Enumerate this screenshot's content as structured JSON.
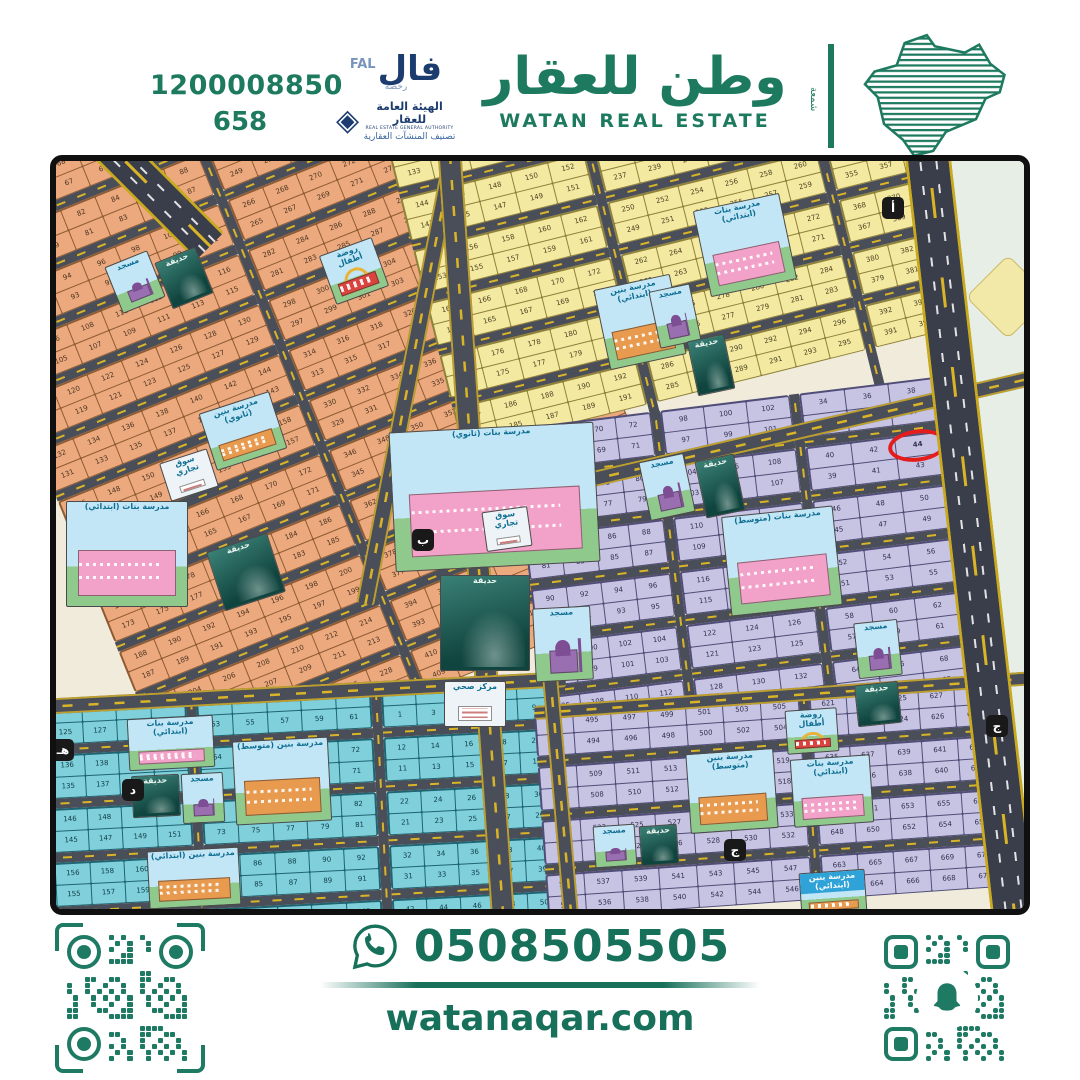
{
  "header": {
    "unified_number": "1200008850",
    "license_number": "658",
    "fal": {
      "logo_ar": "فال",
      "logo_en": "FAL",
      "license_word": "رخصة",
      "authority_ar": "الهيئة العامة للعقار",
      "authority_en": "REAL ESTATE GENERAL AUTHORITY",
      "classification": "تصنيف المنشآت العقارية"
    },
    "brand_ar": "وطن للعقار",
    "brand_en": "WATAN REAL ESTATE",
    "brand_vertical": "شمعة"
  },
  "footer": {
    "phone": "0508505505",
    "website": "watanaqar.com"
  },
  "colors": {
    "brand_teal": "#1E7A5F",
    "navy": "#1C3C70",
    "highlight_red": "#E41C1C",
    "road": "#4A4E58",
    "road_dash": "#D9B427"
  },
  "map": {
    "background": "#F0EBDA",
    "highlight": {
      "district": "lav-right",
      "number": 44,
      "color": "#E41C1C"
    },
    "districts": [
      {
        "id": "orange",
        "x": -160,
        "y": -60,
        "w": 560,
        "h": 760,
        "rot": -22,
        "fill": "#ECA97E",
        "line": "#8F5B33",
        "num": "#4A3422",
        "cols": [
          {
            "w": 260,
            "start": 33
          },
          {
            "w": 290,
            "start": 201
          }
        ]
      },
      {
        "id": "yellow",
        "x": 305,
        "y": -120,
        "w": 650,
        "h": 470,
        "rot": -14,
        "fill": "#F4E9A1",
        "line": "#8F823B",
        "num": "#4A4322",
        "cols": [
          {
            "w": 190,
            "start": 113
          },
          {
            "w": 215,
            "start": 201
          },
          {
            "w": 215,
            "start": 307
          }
        ]
      },
      {
        "id": "lav-right",
        "x": 455,
        "y": 268,
        "w": 560,
        "h": 480,
        "rot": -7,
        "fill": "#C7C3E3",
        "line": "#504E78",
        "num": "#30304E",
        "cols": [
          {
            "w": 140,
            "start": 65
          },
          {
            "w": 130,
            "start": 97
          },
          {
            "w": 135,
            "start": 33
          },
          {
            "w": 135,
            "start": 1
          }
        ]
      },
      {
        "id": "cyan",
        "x": -45,
        "y": 542,
        "w": 540,
        "h": 280,
        "rot": -3,
        "fill": "#7FD0DB",
        "line": "#1F6472",
        "num": "#0E3A44",
        "cols": [
          {
            "w": 175,
            "start": 123
          },
          {
            "w": 175,
            "start": 53
          },
          {
            "w": 170,
            "start": 1
          }
        ]
      },
      {
        "id": "lav-south",
        "x": 478,
        "y": 552,
        "w": 540,
        "h": 230,
        "rot": -4,
        "fill": "#C7C3E3",
        "line": "#504E78",
        "num": "#30304E",
        "cols": [
          {
            "w": 265,
            "start": 492
          },
          {
            "w": 255,
            "start": 620
          }
        ]
      }
    ],
    "roads": [
      {
        "x": 390,
        "y": -20,
        "w": 18,
        "h": 470,
        "rot": 11,
        "kind": "main"
      },
      {
        "x": 380,
        "y": -30,
        "w": 24,
        "h": 840,
        "rot": -4,
        "kind": "main"
      },
      {
        "x": 450,
        "y": 330,
        "w": 570,
        "h": 16,
        "rot": -13,
        "kind": "mainh"
      },
      {
        "x": -20,
        "y": 538,
        "w": 530,
        "h": 16,
        "rot": -3,
        "kind": "mainh"
      },
      {
        "x": 478,
        "y": 545,
        "w": 540,
        "h": 14,
        "rot": -4,
        "kind": "mainh"
      },
      {
        "x": 486,
        "y": 515,
        "w": 16,
        "h": 240,
        "rot": -5,
        "kind": "main"
      },
      {
        "x": 848,
        "y": -10,
        "w": 46,
        "h": 790,
        "rot": -6.5,
        "kind": "highway"
      },
      {
        "x": -30,
        "y": -70,
        "w": 40,
        "h": 240,
        "rot": -45,
        "kind": "highway"
      }
    ],
    "beyond": {
      "x": 890,
      "y": -20,
      "w": 170,
      "h": 820,
      "rot": -6.5
    },
    "arrow": {
      "x": 922,
      "y": 106,
      "size": 60
    },
    "chips": [
      {
        "label": "أ",
        "x": 826,
        "y": 36
      },
      {
        "label": "ب",
        "x": 356,
        "y": 368
      },
      {
        "label": "ج",
        "x": 668,
        "y": 678
      },
      {
        "label": "ج",
        "x": 930,
        "y": 554
      },
      {
        "label": "د",
        "x": 66,
        "y": 618
      },
      {
        "label": "هـ",
        "x": -4,
        "y": 578
      }
    ],
    "landmarks": [
      {
        "type": "mosque",
        "label": "مسجد",
        "x": 56,
        "y": 96,
        "w": 46,
        "h": 50,
        "rot": -22
      },
      {
        "type": "park",
        "label": "حديقة",
        "x": 106,
        "y": 92,
        "w": 44,
        "h": 50,
        "rot": -22
      },
      {
        "type": "kindergarten",
        "label": "روضة أطفال",
        "x": 270,
        "y": 84,
        "w": 56,
        "h": 52,
        "rot": -20
      },
      {
        "type": "school-orange",
        "label": "مدرسة بنين (ثانوي)",
        "x": 150,
        "y": 240,
        "w": 74,
        "h": 60,
        "rot": -18
      },
      {
        "type": "market",
        "label": "سوق تجاري",
        "x": 108,
        "y": 294,
        "w": 50,
        "h": 40,
        "rot": -18
      },
      {
        "type": "school-pink",
        "label": "مدرسة بنات (ابتدائي)",
        "x": 10,
        "y": 340,
        "w": 122,
        "h": 106,
        "rot": 0
      },
      {
        "type": "park",
        "label": "حديقة",
        "x": 158,
        "y": 380,
        "w": 64,
        "h": 62,
        "rot": -18
      },
      {
        "type": "school-pink",
        "label": "مدرسة بنات (ثانوي)",
        "x": 336,
        "y": 266,
        "w": 205,
        "h": 140,
        "rot": -3
      },
      {
        "type": "market",
        "label": "سوق تجاري",
        "x": 428,
        "y": 348,
        "w": 46,
        "h": 40,
        "rot": -8
      },
      {
        "type": "park",
        "label": "حديقة",
        "x": 384,
        "y": 414,
        "w": 90,
        "h": 96,
        "rot": 0
      },
      {
        "type": "mosque",
        "label": "مسجد",
        "x": 478,
        "y": 446,
        "w": 58,
        "h": 74,
        "rot": -3
      },
      {
        "type": "health",
        "label": "مركز صحي",
        "x": 388,
        "y": 520,
        "w": 62,
        "h": 46,
        "rot": 0
      },
      {
        "type": "school-pink",
        "label": "مدرسة بنات (ابتدائي)",
        "x": 645,
        "y": 40,
        "w": 88,
        "h": 88,
        "rot": -12
      },
      {
        "type": "school-orange",
        "label": "مدرسة بنين (ابتدائي)",
        "x": 545,
        "y": 120,
        "w": 78,
        "h": 82,
        "rot": -12
      },
      {
        "type": "mosque",
        "label": "مسجد",
        "x": 598,
        "y": 126,
        "w": 42,
        "h": 58,
        "rot": -12
      },
      {
        "type": "park",
        "label": "حديقة",
        "x": 636,
        "y": 176,
        "w": 38,
        "h": 56,
        "rot": -12
      },
      {
        "type": "mosque",
        "label": "مسجد",
        "x": 588,
        "y": 296,
        "w": 46,
        "h": 60,
        "rot": -12
      },
      {
        "type": "park",
        "label": "حديقة",
        "x": 644,
        "y": 296,
        "w": 40,
        "h": 58,
        "rot": -12
      },
      {
        "type": "school-pink",
        "label": "مدرسة بنات (متوسط)",
        "x": 670,
        "y": 350,
        "w": 112,
        "h": 100,
        "rot": -6
      },
      {
        "type": "mosque",
        "label": "مسجد",
        "x": 800,
        "y": 460,
        "w": 44,
        "h": 56,
        "rot": -6
      },
      {
        "type": "park",
        "label": "حديقة",
        "x": 800,
        "y": 522,
        "w": 44,
        "h": 42,
        "rot": -6
      },
      {
        "type": "school-pink",
        "label": "مدرسة بنات (ابتدائي)",
        "x": 72,
        "y": 556,
        "w": 86,
        "h": 52,
        "rot": -3
      },
      {
        "type": "mosque",
        "label": "مسجد",
        "x": 126,
        "y": 612,
        "w": 42,
        "h": 50,
        "rot": -3
      },
      {
        "type": "park",
        "label": "حديقة",
        "x": 76,
        "y": 614,
        "w": 48,
        "h": 42,
        "rot": -3
      },
      {
        "type": "school-orange",
        "label": "مدرسة بنين (ابتدائي)",
        "x": 92,
        "y": 688,
        "w": 92,
        "h": 58,
        "rot": -3
      },
      {
        "type": "school-orange",
        "label": "مدرسة بنين (متوسط)",
        "x": 178,
        "y": 578,
        "w": 96,
        "h": 84,
        "rot": -3
      },
      {
        "type": "school-orange",
        "label": "مدرسة بنين (متوسط)",
        "x": 632,
        "y": 590,
        "w": 88,
        "h": 80,
        "rot": -4
      },
      {
        "type": "school-pink",
        "label": "مدرسة بنات (ابتدائي)",
        "x": 736,
        "y": 596,
        "w": 80,
        "h": 68,
        "rot": -4
      },
      {
        "type": "kindergarten",
        "label": "روضة أطفال",
        "x": 730,
        "y": 548,
        "w": 52,
        "h": 44,
        "rot": -4
      },
      {
        "type": "mosque",
        "label": "مسجد",
        "x": 538,
        "y": 664,
        "w": 42,
        "h": 42,
        "rot": -4
      },
      {
        "type": "park",
        "label": "حديقة",
        "x": 584,
        "y": 664,
        "w": 38,
        "h": 40,
        "rot": -4
      },
      {
        "type": "school-blue",
        "label": "مدرسة بنين (ابتدائي)",
        "x": 744,
        "y": 710,
        "w": 66,
        "h": 44,
        "rot": -4
      }
    ]
  }
}
